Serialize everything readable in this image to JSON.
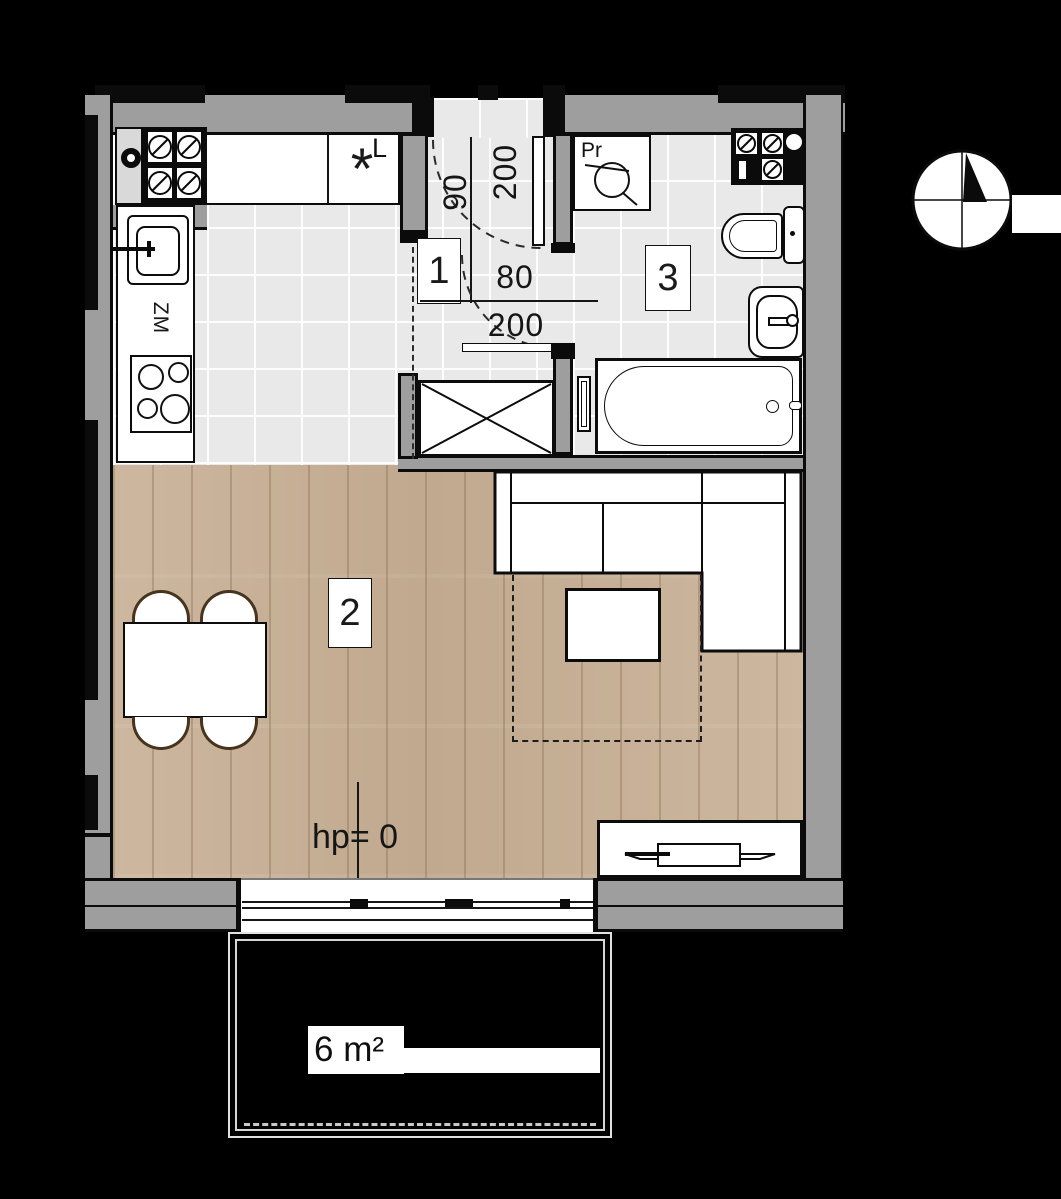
{
  "title": "studio apartment floor plan",
  "rooms": {
    "hall": "1",
    "living": "2",
    "bath": "3"
  },
  "labels": {
    "entry_door_width": "90",
    "entry_door_height": "200",
    "bath_door_width": "80",
    "bath_door_height": "200",
    "fridge_mark": "L",
    "appliance_star": "*",
    "washer_mark": "Pr",
    "dishwasher_mark": "ZM",
    "floor_level": "hp= 0",
    "balcony_area": "6 m²"
  },
  "colors": {
    "background": "#000000",
    "wall": "#9e9e9e",
    "outline": "#0c0c0c",
    "tile_floor": "#e9e9e9",
    "wood_floor": "#c8b199",
    "chair_outline": "#46341f"
  }
}
